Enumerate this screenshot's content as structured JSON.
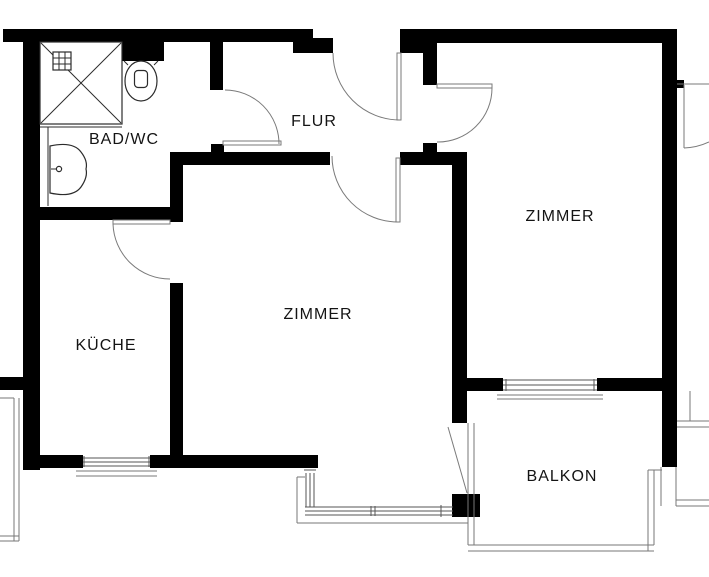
{
  "plan": {
    "type": "apartment-floor-plan",
    "language": "de"
  },
  "rooms": [
    {
      "id": "bad-wc",
      "label": "BAD/WC"
    },
    {
      "id": "flur",
      "label": "FLUR"
    },
    {
      "id": "zimmer-right",
      "label": "ZIMMER"
    },
    {
      "id": "zimmer-middle",
      "label": "ZIMMER"
    },
    {
      "id": "kueche",
      "label": "KÜCHE"
    },
    {
      "id": "balkon",
      "label": "BALKON"
    }
  ],
  "fixtures": [
    {
      "id": "shower-icon"
    },
    {
      "id": "toilet-icon"
    },
    {
      "id": "sink-icon"
    }
  ],
  "colors": {
    "bg": "#ffffff",
    "wall": "#000000",
    "door": "#7a7a7a",
    "win": "#555555",
    "rail": "#777777",
    "fix": "#2b2b2b",
    "label": "#141414"
  }
}
